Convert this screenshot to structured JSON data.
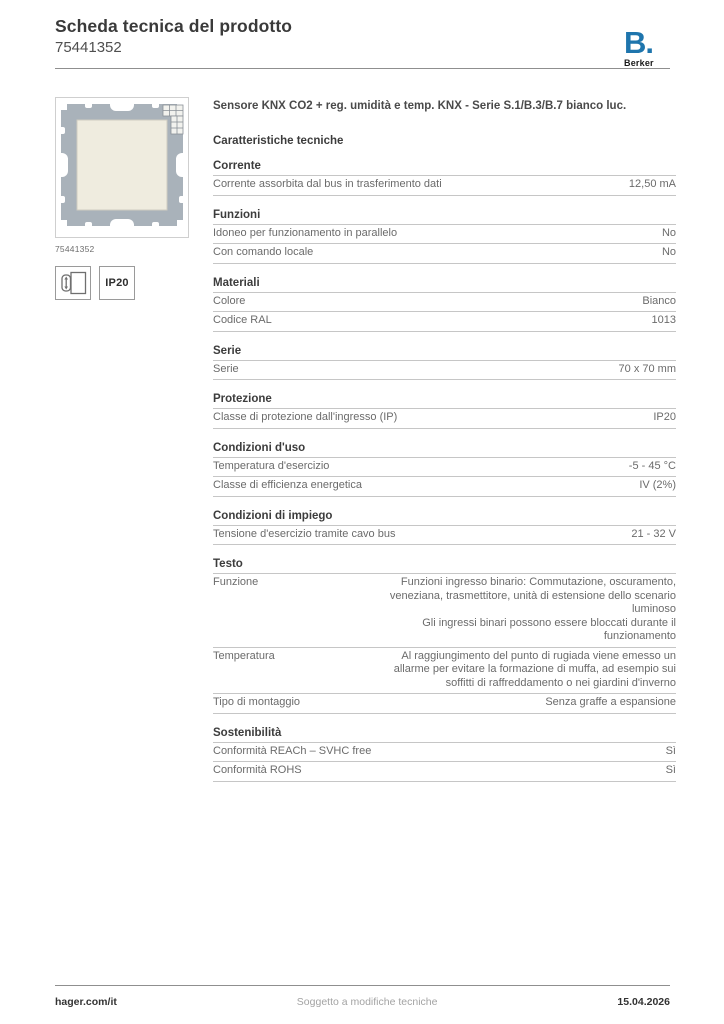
{
  "header": {
    "title": "Scheda tecnica del prodotto",
    "product_number": "75441352"
  },
  "brand": {
    "mark": "B.",
    "name": "Berker",
    "color": "#1e75ad"
  },
  "product": {
    "image_caption": "75441352",
    "image_colors": {
      "plate_gray": "#a9b2ba",
      "cover_cream": "#efecdf"
    },
    "badges": [
      {
        "icon": "flush-mount-icon"
      },
      {
        "icon": "ip20-badge",
        "label": "IP20"
      }
    ],
    "title": "Sensore KNX CO2 + reg. umidità e temp. KNX - Serie S.1/B.3/B.7 bianco luc."
  },
  "specs": {
    "heading": "Caratteristiche tecniche",
    "sections": [
      {
        "title": "Corrente",
        "rows": [
          {
            "label": "Corrente assorbita dal bus in trasferimento dati",
            "value": "12,50 mA"
          }
        ]
      },
      {
        "title": "Funzioni",
        "rows": [
          {
            "label": "Idoneo per funzionamento in parallelo",
            "value": "No"
          },
          {
            "label": "Con comando locale",
            "value": "No"
          }
        ]
      },
      {
        "title": "Materiali",
        "rows": [
          {
            "label": "Colore",
            "value": "Bianco"
          },
          {
            "label": "Codice RAL",
            "value": "1013"
          }
        ]
      },
      {
        "title": "Serie",
        "rows": [
          {
            "label": "Serie",
            "value": "70 x 70 mm"
          }
        ]
      },
      {
        "title": "Protezione",
        "rows": [
          {
            "label": "Classe di protezione dall'ingresso (IP)",
            "value": "IP20"
          }
        ]
      },
      {
        "title": "Condizioni d'uso",
        "rows": [
          {
            "label": "Temperatura d'esercizio",
            "value": "-5 - 45 °C"
          },
          {
            "label": "Classe di efficienza energetica",
            "value": "IV (2%)"
          }
        ]
      },
      {
        "title": "Condizioni di impiego",
        "rows": [
          {
            "label": "Tensione d'esercizio tramite cavo bus",
            "value": "21 - 32 V"
          }
        ]
      },
      {
        "title": "Testo",
        "rows": [
          {
            "label": "Funzione",
            "multiline": true,
            "value": "Funzioni ingresso binario: Commutazione, oscuramento, veneziana, trasmettitore, unità di estensione dello scenario luminoso\nGli ingressi binari possono essere bloccati durante il funzionamento"
          },
          {
            "label": "Temperatura",
            "multiline": true,
            "value": "Al raggiungimento del punto di rugiada viene emesso un allarme per evitare la formazione di muffa, ad esempio sui soffitti di raffreddamento o nei giardini d'inverno"
          },
          {
            "label": "Tipo di montaggio",
            "value": "Senza graffe a espansione"
          }
        ]
      },
      {
        "title": "Sostenibilità",
        "rows": [
          {
            "label": "Conformità REACh – SVHC free",
            "value": "Sì"
          },
          {
            "label": "Conformità ROHS",
            "value": "Sì"
          }
        ]
      }
    ]
  },
  "footer": {
    "site": "hager.com/it",
    "note": "Soggetto a modifiche tecniche",
    "date": "15.04.2026"
  }
}
